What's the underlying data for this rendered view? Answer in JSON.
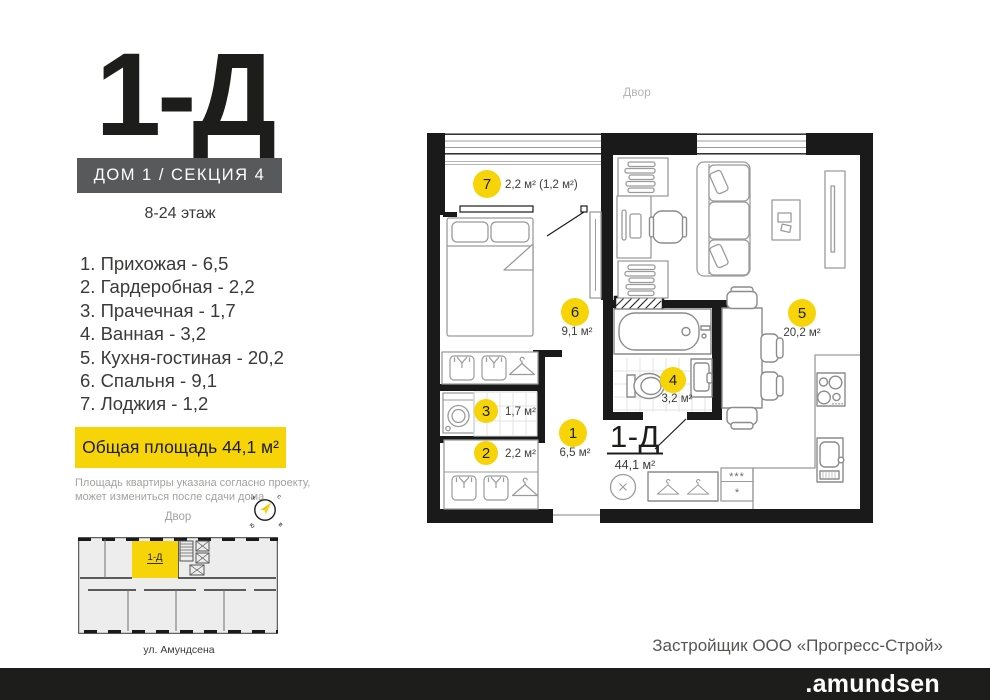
{
  "header": {
    "logo": "1-Д",
    "house_section": "ДОМ 1 / СЕКЦИЯ 4",
    "floors": "8-24 этаж"
  },
  "room_list": [
    {
      "label": "1.  Прихожая - 6,5"
    },
    {
      "label": "2.  Гардеробная - 2,2"
    },
    {
      "label": "3.  Прачечная - 1,7"
    },
    {
      "label": "4.  Ванная - 3,2"
    },
    {
      "label": "5.  Кухня-гостиная - 20,2"
    },
    {
      "label": "6.  Спальня - 9,1"
    },
    {
      "label": "7.  Лоджия - 1,2"
    }
  ],
  "total_area_label": "Общая площадь 44,1 м²",
  "disclaimer": {
    "line1": "Площадь квартиры указана согласно проекту,",
    "line2": "может измениться после сдачи дома"
  },
  "orientation": {
    "yard": "Двор",
    "compass": {
      "north": "с",
      "east": "в",
      "south": "ю",
      "west": "з"
    }
  },
  "mini_plan": {
    "unit": "1-Д",
    "street": "ул. Амундсена"
  },
  "plan": {
    "yard": "Двор",
    "unit_title": "1-Д",
    "unit_area": "44,1 м²",
    "rooms": {
      "r1": {
        "num": "1",
        "area": "6,5 м²"
      },
      "r2": {
        "num": "2",
        "area": "2,2 м²"
      },
      "r3": {
        "num": "3",
        "area": "1,7 м²"
      },
      "r4": {
        "num": "4",
        "area": "3,2 м²"
      },
      "r5": {
        "num": "5",
        "area": "20,2 м²"
      },
      "r6": {
        "num": "6",
        "area": "9,1 м²"
      },
      "r7": {
        "num": "7",
        "area": "2,2 м² (1,2 м²)"
      }
    },
    "fridge": {
      "row1": "***",
      "row2": "*"
    }
  },
  "footer": {
    "developer": "Застройщик ООО «Прогресс-Строй»",
    "brand": ".amundsen"
  },
  "colors": {
    "accent": "#f6d408",
    "panel_gray": "#58595b",
    "ink": "#1d1d1b",
    "muted": "#9d9d9c"
  }
}
